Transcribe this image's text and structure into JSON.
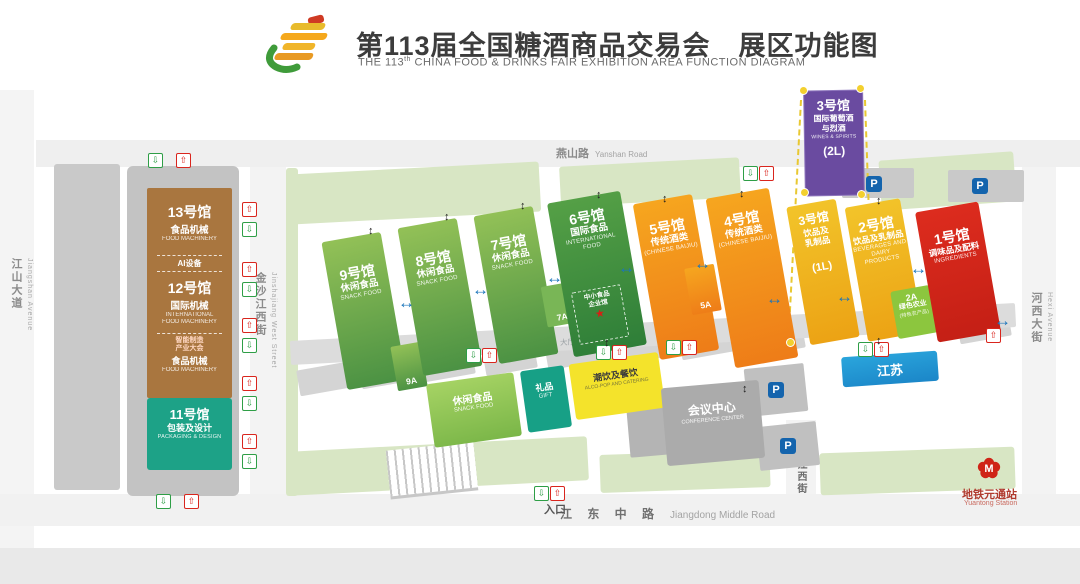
{
  "header": {
    "title_zh": "第113届全国糖酒商品交易会　展区功能图",
    "title_en_prefix": "THE 113",
    "title_en_sup": "th",
    "title_en_rest": " CHINA FOOD & DRINKS FAIR EXHIBITION AREA FUNCTION DIAGRAM"
  },
  "roads": {
    "yanshan_zh": "燕山路",
    "yanshan_en": "Yanshan Road",
    "jiangshan_zh": "江山大道",
    "jiangshan_en": "Jiangshan Avenue",
    "jinshajiang_zh": "金沙江西街",
    "jinshajiang_en": "Jinshajiang West Street",
    "hexi_zh": "河西大街",
    "hexi_en": "Hexi Avenue",
    "jiangdong_zh": "江 东 中 路",
    "jiangdong_en": "Jiangdong Middle Road",
    "bailongjiang_zh": "白龙江西街"
  },
  "halls": {
    "h13": {
      "num": "13号馆",
      "cat_zh": "食品机械",
      "cat_en": "FOOD MACHINERY"
    },
    "ai_zone": "AI设备",
    "h12": {
      "num": "12号馆",
      "cat_zh": "国际机械",
      "cat_en1": "INTERNATIONAL",
      "cat_en2": "FOOD MACHINERY"
    },
    "h12_sub": {
      "tag1": "智能制造",
      "tag2": "产业大会",
      "cat_zh": "食品机械",
      "cat_en": "FOOD MACHINERY"
    },
    "h11": {
      "num": "11号馆",
      "cat_zh": "包装及设计",
      "cat_en": "PACKAGING & DESIGN"
    },
    "h9": {
      "num": "9号馆",
      "cat_zh": "休闲食品",
      "cat_en": "SNACK FOOD",
      "annex": "9A"
    },
    "h8": {
      "num": "8号馆",
      "cat_zh": "休闲食品",
      "cat_en": "SNACK FOOD"
    },
    "h7": {
      "num": "7号馆",
      "cat_zh": "休闲食品",
      "cat_en": "SNACK FOOD",
      "annex": "7A"
    },
    "h6": {
      "num": "6号馆",
      "cat_zh": "国际食品",
      "cat_en1": "INTERNATIONAL",
      "cat_en2": "FOOD",
      "sub1": "中小食品",
      "sub2": "企业馆"
    },
    "h5": {
      "num": "5号馆",
      "cat_zh": "传统酒类",
      "cat_en": "(CHINESE BAIJIU)",
      "annex": "5A"
    },
    "h4": {
      "num": "4号馆",
      "cat_zh": "传统酒类",
      "cat_en": "(CHINESE BAIJIU)"
    },
    "h3_2l": {
      "num": "3号馆",
      "cat_zh1": "国际葡萄酒",
      "cat_zh2": "与烈酒",
      "cat_en": "WINES & SPIRITS",
      "floor": "(2L)"
    },
    "h3_1l": {
      "num": "3号馆",
      "cat_zh1": "饮品及",
      "cat_zh2": "乳制品",
      "floor": "(1L)"
    },
    "h2": {
      "num": "2号馆",
      "cat_zh": "饮品及乳制品",
      "cat_en1": "BEVERAGES AND",
      "cat_en2": "DAIRY PRODUCTS"
    },
    "h2a": {
      "code": "2A",
      "cat_zh": "绿色农业",
      "cat_sub": "(特色农产品)"
    },
    "h1": {
      "num": "1号馆",
      "cat_zh": "调味品及配料",
      "cat_en": "INGREDIENTS"
    }
  },
  "facilities": {
    "snack": {
      "zh": "休闲食品",
      "en": "SNACK FOOD"
    },
    "gift": {
      "zh": "礼品",
      "en": "GIFT"
    },
    "alcopop": {
      "zh": "潮饮及餐饮",
      "en": "ALCO-POP AND CATERING"
    },
    "conference": {
      "zh": "会议中心",
      "en": "CONFERENCE CENTER"
    },
    "jiangsu": {
      "zh": "江苏"
    },
    "corridor_label": "大厅连接通道"
  },
  "markers": {
    "entrance": "入口",
    "parking": "P",
    "metro_zh": "地铁元通站",
    "metro_en": "Yuantong Station"
  },
  "colors": {
    "snack_green": "#5ea83f",
    "intl_green": "#2f8f3c",
    "baijiu_orange": "#ef8b15",
    "beverage_amber": "#eeb31c",
    "ingredients_red": "#d1261a",
    "wines_purple": "#6a4ba0",
    "machinery_brown": "#a9763f",
    "packaging_teal": "#1da287",
    "jiangsu_blue": "#1f97d4",
    "parking_blue": "#1464ad",
    "lawn_green": "#d8e6c4"
  }
}
